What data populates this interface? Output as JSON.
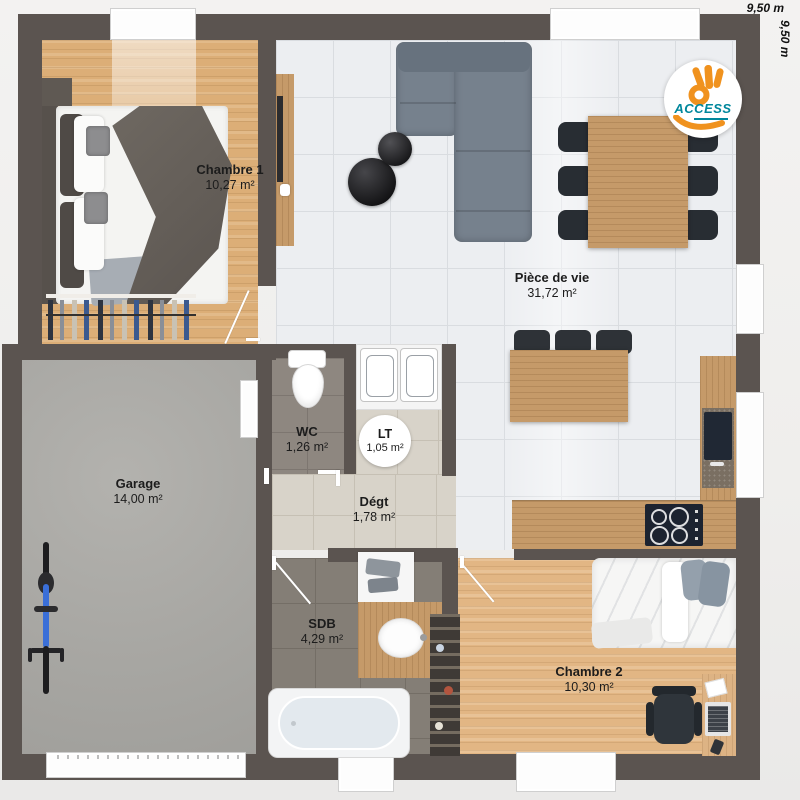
{
  "plan": {
    "dimensions": {
      "top": "9,50 m",
      "side": "9,50 m"
    },
    "logo": {
      "text": "ACCESS"
    },
    "rooms": [
      {
        "name": "Chambre 1",
        "area": "10,27 m²"
      },
      {
        "name": "Pièce de vie",
        "area": "31,72 m²"
      },
      {
        "name": "WC",
        "area": "1,26 m²"
      },
      {
        "name": "LT",
        "area": "1,05 m²"
      },
      {
        "name": "Dégt",
        "area": "1,78 m²"
      },
      {
        "name": "Garage",
        "area": "14,00 m²"
      },
      {
        "name": "SDB",
        "area": "4,29 m²"
      },
      {
        "name": "Chambre 2",
        "area": "10,30 m²"
      }
    ],
    "colors": {
      "wall": "#5b5450",
      "accent_orange": "#f0921e",
      "accent_teal": "#00879c"
    }
  }
}
